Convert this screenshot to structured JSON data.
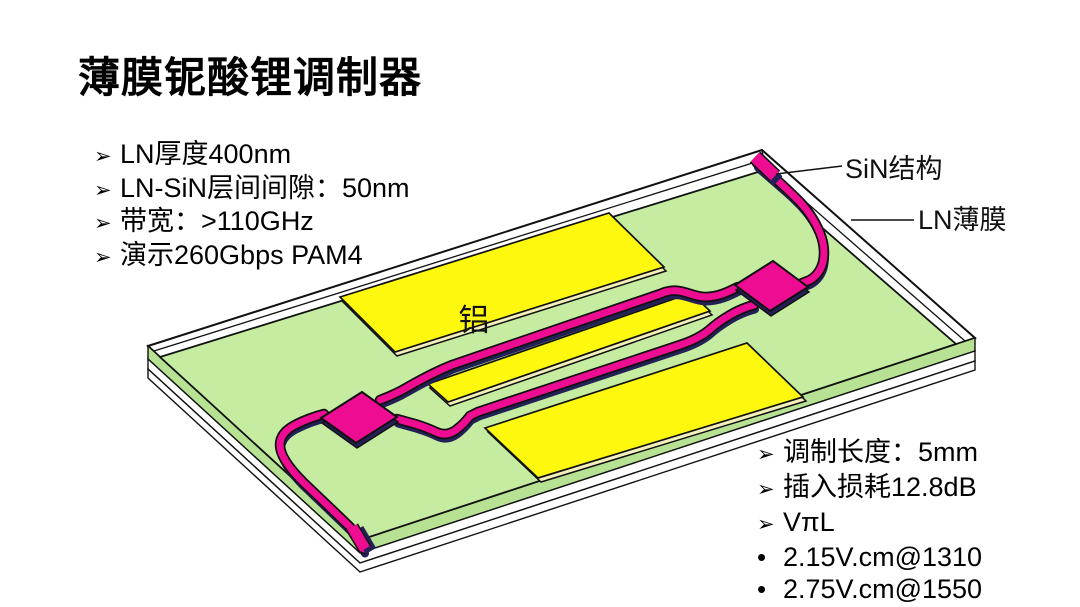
{
  "slide": {
    "title": "薄膜铌酸锂调制器",
    "background_color": "#ffffff"
  },
  "specs_left": {
    "bullet": "➢",
    "items": [
      "LN厚度400nm",
      "LN-SiN层间间隙：50nm",
      "带宽：>110GHz",
      "演示260Gbps PAM4"
    ]
  },
  "specs_right": {
    "items": [
      {
        "bullet": "➢",
        "text": "调制长度：5mm"
      },
      {
        "bullet": "➢",
        "text": "插入损耗12.8dB"
      },
      {
        "bullet": "➢",
        "text": "VπL"
      },
      {
        "bullet": "•",
        "text": "2.15V.cm@1310"
      },
      {
        "bullet": "•",
        "text": "2.75V.cm@1550"
      }
    ]
  },
  "diagram": {
    "labels": {
      "sin_structure": "SiN结构",
      "ln_film": "LN薄膜",
      "aluminum": "铝"
    },
    "colors": {
      "chip_top_green": "#c6eca1",
      "chip_side_green": "#b7e293",
      "substrate_white": "#ffffff",
      "electrode_yellow": "#fdf80d",
      "electrode_side": "#f4f0bb",
      "waveguide_pink": "#ee0c93",
      "waveguide_shadow_navy": "#232057",
      "outline_black": "#111111"
    }
  }
}
